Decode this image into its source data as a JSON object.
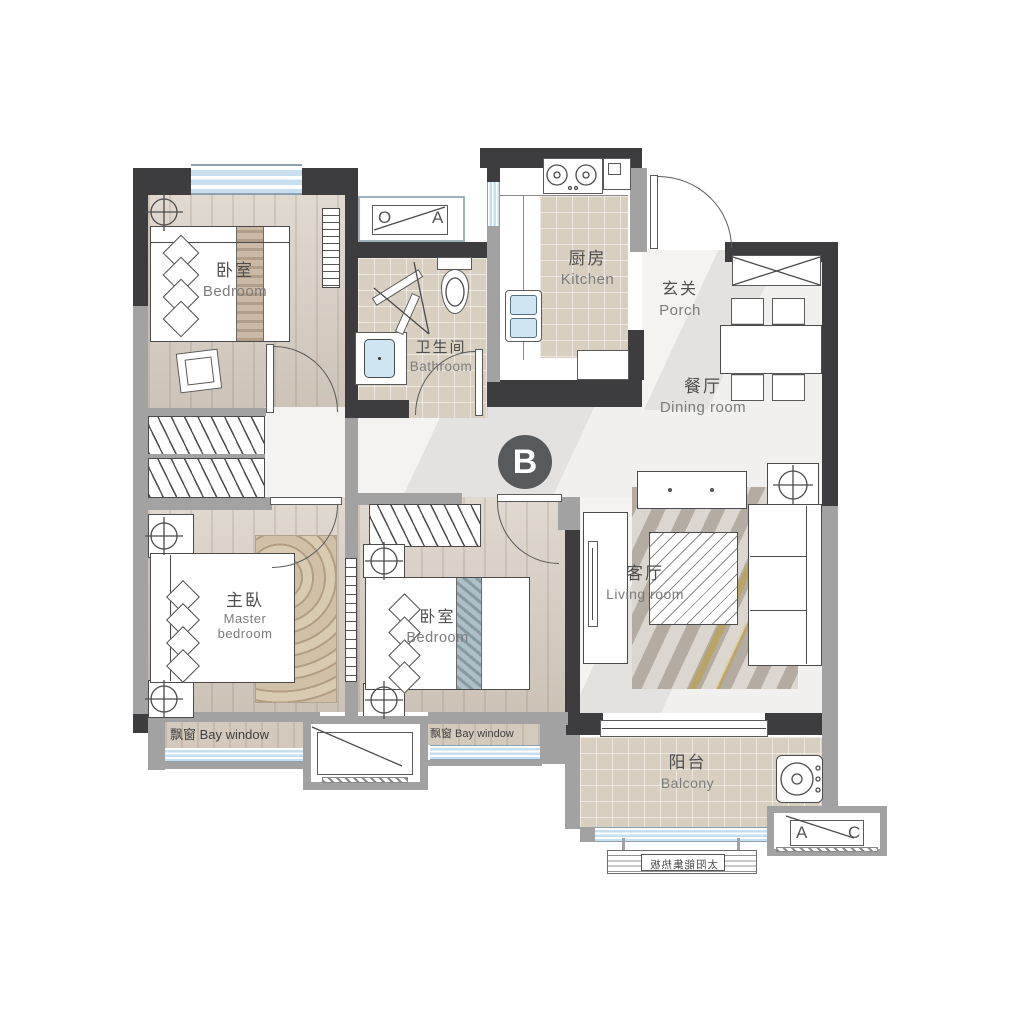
{
  "plan": {
    "marker_b": "B",
    "rooms": {
      "bedroom_top": {
        "zh": "卧室",
        "en": "Bedroom"
      },
      "bathroom": {
        "zh": "卫生间",
        "en": "Bathroom"
      },
      "kitchen": {
        "zh": "厨房",
        "en": "Kitchen"
      },
      "porch": {
        "zh": "玄关",
        "en": "Porch"
      },
      "dining": {
        "zh": "餐厅",
        "en": "Dining room"
      },
      "master_bedroom": {
        "zh": "主臥",
        "en": "Master bedroom"
      },
      "bedroom_middle": {
        "zh": "卧室",
        "en": "Bedroom"
      },
      "living_room": {
        "zh": "客厅",
        "en": "Living room"
      },
      "balcony": {
        "zh": "阳台",
        "en": "Balcony"
      }
    },
    "bay_window_left": "飘窗 Bay window",
    "bay_window_middle": "飘窗 Bay window",
    "ac_platform_top": {
      "left": "O",
      "right": "A"
    },
    "ac_platform_bottom_right": {
      "left": "A",
      "right": "C"
    },
    "solar_panel_label": "太阳能集热板",
    "colors": {
      "wall_dark": "#3d3d3f",
      "wall_gray": "#a2a2a2",
      "window_blue": "#c7dfee",
      "wood_floor": "#d7cdc1",
      "tile_gray": "#e8e7e5",
      "tile_beige": "#d8cfc0",
      "marker_background": "#58595b"
    }
  }
}
